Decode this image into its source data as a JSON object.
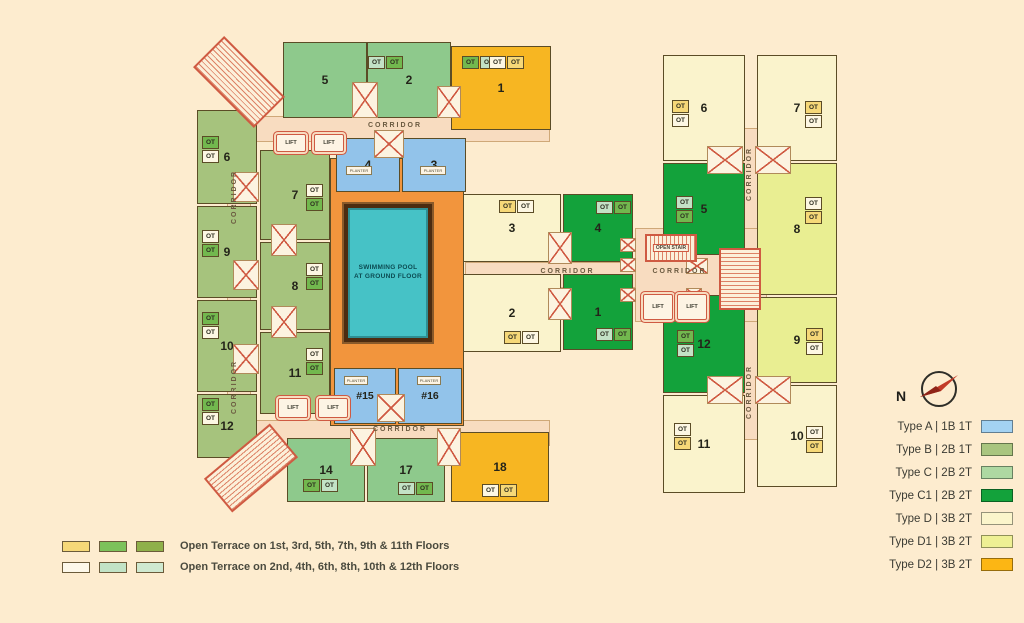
{
  "labels": {
    "ot": "OT",
    "corridor": "CORRIDOR",
    "lift": "LIFT",
    "planter": "PLANTER",
    "open_stair": "OPEN STAIR",
    "north": "N",
    "pool_line1": "SWIMMING POOL",
    "pool_line2": "AT GROUND FLOOR"
  },
  "plan": {
    "left_wing_units": {
      "n1": "1",
      "n2": "2",
      "n3": "3",
      "n4": "4",
      "n5": "5",
      "n6": "6",
      "n7": "7",
      "n8": "8",
      "n9": "9",
      "n10": "10",
      "n11": "11",
      "n12": "12",
      "n14": "14",
      "n15": "#15",
      "n16": "#16",
      "n17": "17",
      "n18": "18"
    },
    "mid_units": {
      "n1": "1",
      "n2": "2",
      "n3": "3",
      "n4": "4"
    },
    "right_wing_units": {
      "n5": "5",
      "n6": "6",
      "n7": "7",
      "n8": "8",
      "n9": "9",
      "n10": "10",
      "n11": "11",
      "n12": "12"
    }
  },
  "legend": {
    "unit_types": [
      {
        "label": "Type A | 1B 1T",
        "color": "#a3d2f2"
      },
      {
        "label": "Type B | 2B 1T",
        "color": "#a9c57f"
      },
      {
        "label": "Type C | 2B 2T",
        "color": "#aed8a2"
      },
      {
        "label": "Type C1 | 2B 2T",
        "color": "#13a23b"
      },
      {
        "label": "Type D | 3B 2T",
        "color": "#fbf5cb"
      },
      {
        "label": "Type D1 | 3B 2T",
        "color": "#eef094"
      },
      {
        "label": "Type D2 | 3B 2T",
        "color": "#fcb614"
      }
    ],
    "terrace": [
      {
        "text": "Open Terrace on 1st, 3rd, 5th, 7th, 9th & 11th Floors",
        "c1": "#f6d878",
        "c2": "#7cc25b",
        "c3": "#8fb04a"
      },
      {
        "text": "Open Terrace on 2nd, 4th, 6th, 8th, 10th & 12th Floors",
        "c1": "#fdf8ea",
        "c2": "#c2e3c6",
        "c3": "#cfe9d0"
      }
    ]
  },
  "palette": {
    "background": "#fdeccf",
    "corridor": "#f8dcc0",
    "courtyard": "#f2953d",
    "pool_water": "#46c2c6",
    "red_line": "#cf5a42",
    "type_a": "#92c3ea",
    "type_b": "#a6c37d",
    "type_c": "#8ec98c",
    "type_c1": "#13a23b",
    "type_d": "#faf3cc",
    "type_d1": "#e9ee92",
    "type_d2": "#f7b622",
    "ot_green": "#72b84e",
    "ot_mint": "#c3e2c6",
    "ot_cream": "#fdf7e3",
    "ot_yellow": "#f6d878",
    "compass_needle": "#c23b28"
  }
}
